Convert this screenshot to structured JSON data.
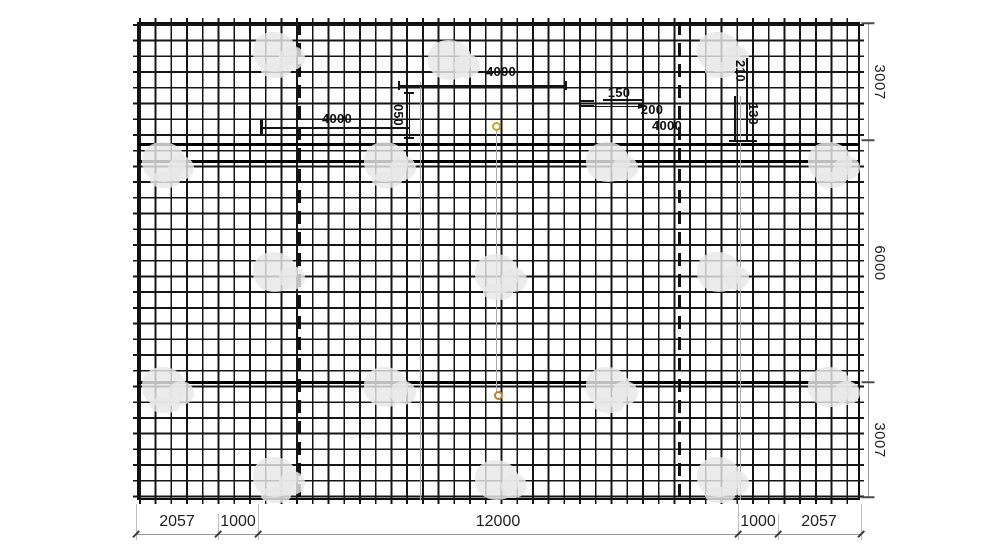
{
  "annotations": {
    "dim_top_4000": "4000",
    "dim_mid_4000": "4000",
    "leader_150": "150",
    "leader_200": "200",
    "leader_4000": "4000",
    "vdim_left": "050",
    "vdim_right_a": "210",
    "vdim_right_b": "130"
  },
  "bottom_dims": [
    "2057",
    "1000",
    "12000",
    "1000",
    "2057"
  ],
  "right_dims": [
    "3007",
    "6000",
    "3007"
  ],
  "colors": {
    "wire": "#161616",
    "dimension_text": "#1f1f1f",
    "extension_line": "#bcbcbc",
    "circle_marker_top": "#c9a227",
    "circle_marker_bottom": "#bf7f2a",
    "watermark": "#e8e8e8"
  }
}
